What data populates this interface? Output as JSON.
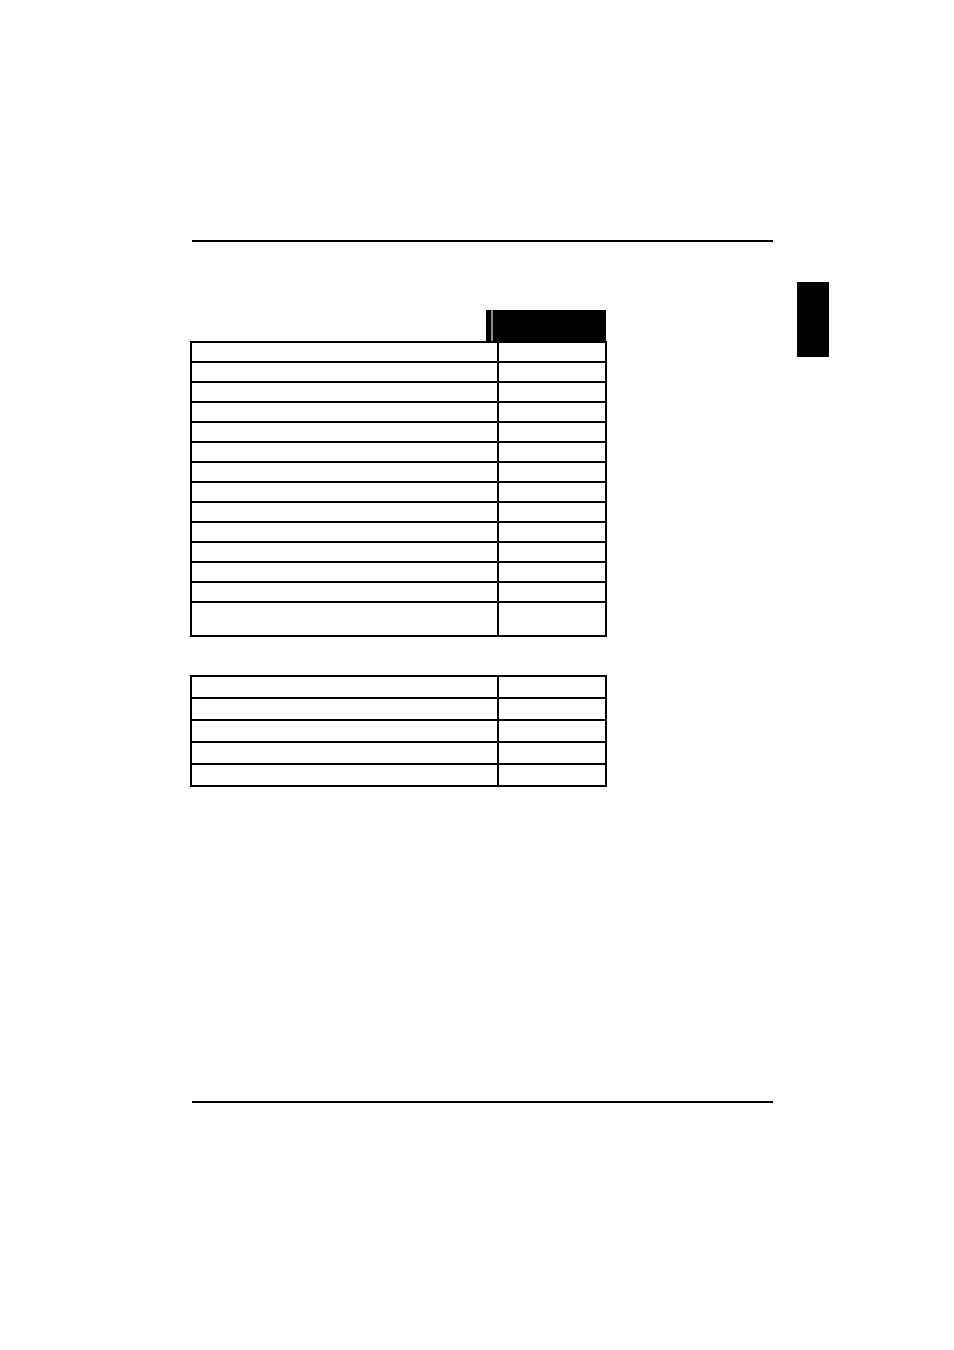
{
  "page": {
    "background_color": "#ffffff",
    "rule_color": "#000000"
  },
  "top_rule": {
    "present": true
  },
  "bottom_rule": {
    "present": true
  },
  "table1": {
    "header": {
      "label": "",
      "fill_color": "#000000",
      "text_color": "#ffffff"
    },
    "column_count": 2,
    "rows": [
      [
        "",
        ""
      ],
      [
        "",
        ""
      ],
      [
        "",
        ""
      ],
      [
        "",
        ""
      ],
      [
        "",
        ""
      ],
      [
        "",
        ""
      ],
      [
        "",
        ""
      ],
      [
        "",
        ""
      ],
      [
        "",
        ""
      ],
      [
        "",
        ""
      ],
      [
        "",
        ""
      ],
      [
        "",
        ""
      ],
      [
        "",
        ""
      ],
      [
        "",
        ""
      ]
    ]
  },
  "table2": {
    "column_count": 2,
    "rows": [
      [
        "",
        ""
      ],
      [
        "",
        ""
      ],
      [
        "",
        ""
      ],
      [
        "",
        ""
      ],
      [
        "",
        ""
      ]
    ]
  },
  "side_tab": {
    "label": "",
    "fill_color": "#000000"
  }
}
